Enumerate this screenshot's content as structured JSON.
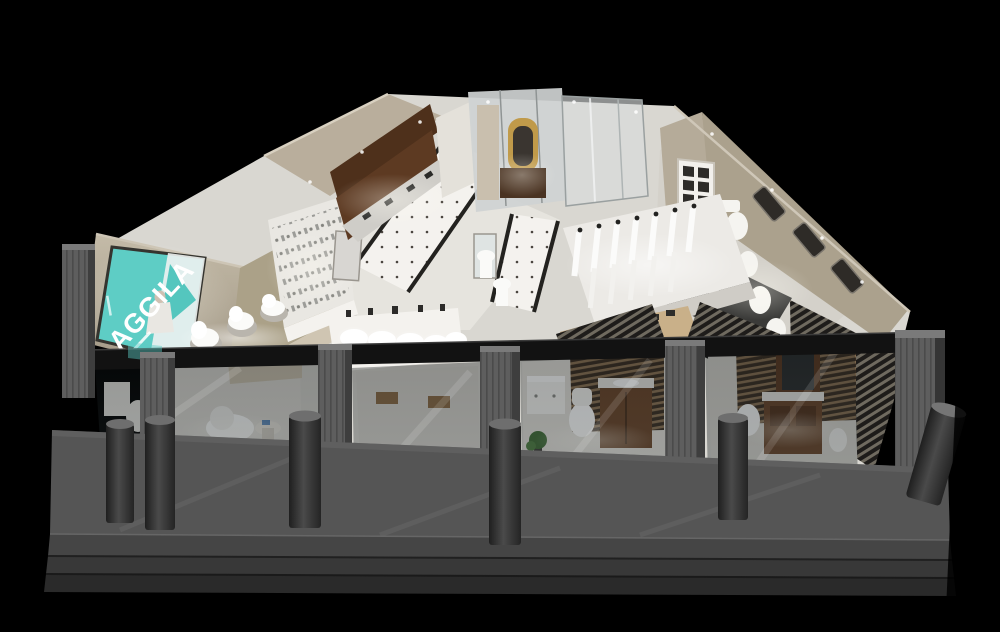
{
  "scene": {
    "alt": "Isometric 3D cutaway render of an AGGILA bathroom fixtures showroom at night, black background, glass storefront with grey pillars, bollards and entrance steps"
  },
  "logo": {
    "text": "AGGILA"
  },
  "colors": {
    "background": "#000000",
    "brand_teal": "#5ecdc5",
    "logo_text": "#ffffff",
    "wall_beige": "#b3a892",
    "floor_light": "#d9d7d1",
    "tile_white": "#f4f2ee",
    "wood_dark": "#5d3a22",
    "wood_mid": "#8a6a45",
    "walkway_grey": "#555555",
    "step_grey": "#3a3a3a",
    "pillar_grey": "#606060",
    "frame_black": "#141414",
    "glass_tint": "#161d20",
    "gold_mirror": "#c09a4a",
    "plant_green": "#3f6b35"
  }
}
